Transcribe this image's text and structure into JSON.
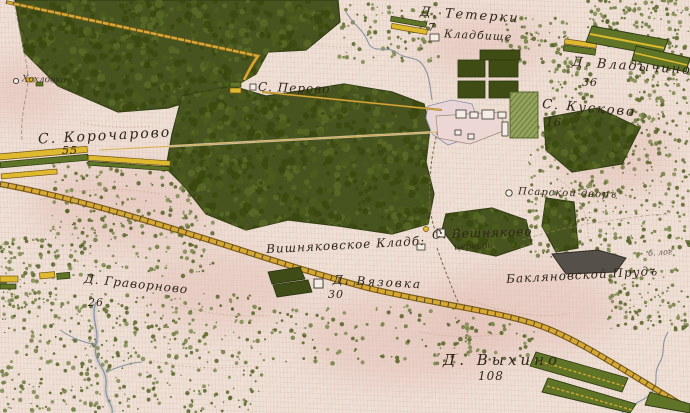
{
  "map_type": "historical topographic map (environs of Moscow, 19th century)",
  "labels": {
    "teterki": {
      "name": "Д. Тетерки",
      "number": "7"
    },
    "kladbishche": {
      "name": "Кладбище"
    },
    "perovo": {
      "name": "С. Перово"
    },
    "vladychino": {
      "name": "Д. Владычино",
      "number": "36"
    },
    "kuskovo": {
      "name": "С. Кусково",
      "number": "16"
    },
    "khokhlovka": {
      "name": "Хохловка"
    },
    "korochartovo": {
      "name": "С. Корочарово",
      "number": "55"
    },
    "psarskoy": {
      "name": "Псарской дворъ"
    },
    "veshnyakovo": {
      "name": "С. Вешняково",
      "sub": "церковь"
    },
    "veshn_kladb": {
      "name": "Вишняковское Кладб:"
    },
    "vyazovka": {
      "name": "Д. Вязовка",
      "number": "30"
    },
    "gravornovo": {
      "name": "Д. Граворново",
      "number": "26"
    },
    "baklyan_prud": {
      "name": "Бакляновской Прудъ"
    },
    "b_log": {
      "name": "б. лог"
    },
    "vykhino": {
      "name": "Д. Выхино",
      "number": "108"
    }
  },
  "colors": {
    "paper": "#efe0d6",
    "forest": "#47541f",
    "road_yellow": "#d8a832",
    "building_yellow": "#dfb92e",
    "building_green": "#5f7426",
    "water": "#8593a2",
    "pond_dark": "#56504a",
    "ink": "#2f2519"
  }
}
